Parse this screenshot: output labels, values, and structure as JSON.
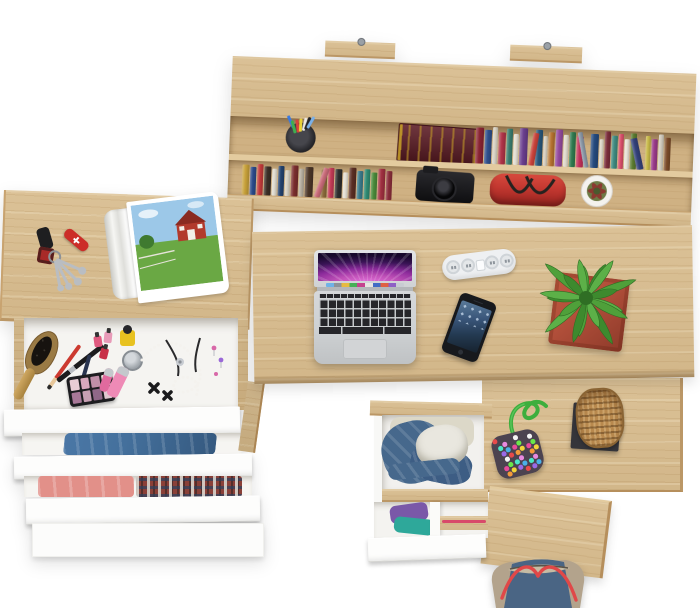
{
  "scene": {
    "kind": "top-down 3d render of a desk workspace set",
    "background": "#ffffff",
    "furniture_finish": "light oak with white drawer fronts"
  },
  "colors": {
    "wood": "#d9be91",
    "niche": "#cfb183",
    "wall_pink": "#e070d8",
    "wall_purple": "#8a2a9a",
    "wall_dark": "#17082b",
    "mac_keys": "#26262a",
    "basket": "#b8894e"
  },
  "hutch": {
    "label": "wall-mounted shelf unit with books",
    "wall_tabs": 2,
    "pen_cup": {
      "cup": "#2b2b2e",
      "pen_colors": [
        "#3a7ae0",
        "#3fae4f",
        "#d8433a",
        "#e8d23a",
        "#ece9e4",
        "#222226",
        "#7ab0e8"
      ]
    },
    "large_book": {
      "label": "antique dark-red book with gold ornament",
      "cover": "#5c1b24",
      "ornament": "#c9a227"
    },
    "camera": {
      "label": "black camera",
      "body": "#141414"
    },
    "handbag": {
      "label": "red handbag",
      "body": "#c23730",
      "strap": "#26221f"
    },
    "plant_pot": {
      "pot": "#f4f2ee",
      "foliage": "#6e7a46",
      "accent": "#8a3a30"
    },
    "top_shelf_books": [
      {
        "c": "#8a2433",
        "w": 8,
        "h": 36,
        "t": 0
      },
      {
        "c": "#2e4f8c",
        "w": 7,
        "h": 34,
        "t": 0
      },
      {
        "c": "#d8d2c4",
        "w": 5,
        "h": 37,
        "t": 0
      },
      {
        "c": "#b03448",
        "w": 7,
        "h": 32,
        "t": 0
      },
      {
        "c": "#3a7d6e",
        "w": 6,
        "h": 36,
        "t": 0
      },
      {
        "c": "#e3ded2",
        "w": 5,
        "h": 31,
        "t": 0
      },
      {
        "c": "#6a3e8e",
        "w": 8,
        "h": 37,
        "t": 0
      },
      {
        "c": "#c9423a",
        "w": 6,
        "h": 33,
        "t": 8
      },
      {
        "c": "#28567a",
        "w": 7,
        "h": 36,
        "t": 0
      },
      {
        "c": "#d6cfc0",
        "w": 4,
        "h": 30,
        "t": 0
      },
      {
        "c": "#b5722f",
        "w": 6,
        "h": 34,
        "t": 0
      },
      {
        "c": "#944a9e",
        "w": 7,
        "h": 37,
        "t": 0
      },
      {
        "c": "#e0dacc",
        "w": 5,
        "h": 32,
        "t": 0
      },
      {
        "c": "#2f7a4f",
        "w": 6,
        "h": 35,
        "t": 0
      },
      {
        "c": "#c2315a",
        "w": 7,
        "h": 31,
        "t": 0
      },
      {
        "c": "#8a97a6",
        "w": 5,
        "h": 36,
        "t": -12
      },
      {
        "c": "#254a7e",
        "w": 8,
        "h": 34,
        "t": 0
      },
      {
        "c": "#ddd7c9",
        "w": 4,
        "h": 29,
        "t": 0
      },
      {
        "c": "#7a2d3a",
        "w": 6,
        "h": 37,
        "t": 0
      },
      {
        "c": "#3f8a80",
        "w": 6,
        "h": 33,
        "t": 0
      },
      {
        "c": "#d94f6a",
        "w": 5,
        "h": 35,
        "t": 0
      },
      {
        "c": "#e8e3d6",
        "w": 5,
        "h": 30,
        "t": 0
      },
      {
        "c": "#5a7a2f",
        "w": 6,
        "h": 36,
        "t": 0
      },
      {
        "c": "#33417a",
        "w": 7,
        "h": 32,
        "t": -14
      },
      {
        "c": "#c8b94a",
        "w": 5,
        "h": 34,
        "t": 0
      },
      {
        "c": "#9a3a8a",
        "w": 6,
        "h": 31,
        "t": 0
      },
      {
        "c": "#d0cabc",
        "w": 5,
        "h": 36,
        "t": 0
      },
      {
        "c": "#7a4a28",
        "w": 6,
        "h": 33,
        "t": 0
      }
    ],
    "lower_shelf_books": [
      {
        "c": "#c8a13a",
        "w": 7,
        "h": 30,
        "t": 0
      },
      {
        "c": "#2b4a8a",
        "w": 6,
        "h": 28,
        "t": 0
      },
      {
        "c": "#c23a3a",
        "w": 6,
        "h": 31,
        "t": 0
      },
      {
        "c": "#3a2e26",
        "w": 7,
        "h": 29,
        "t": 0
      },
      {
        "c": "#e0dcd0",
        "w": 5,
        "h": 27,
        "t": 0
      },
      {
        "c": "#23426e",
        "w": 6,
        "h": 30,
        "t": 0
      },
      {
        "c": "#d6d0c2",
        "w": 5,
        "h": 26,
        "t": 0
      },
      {
        "c": "#7a2d2d",
        "w": 7,
        "h": 31,
        "t": 0
      },
      {
        "c": "#b5ad9e",
        "w": 5,
        "h": 28,
        "t": 0
      },
      {
        "c": "#4a3527",
        "w": 8,
        "h": 30,
        "t": 0
      },
      {
        "c": "#c86a78",
        "w": 6,
        "h": 31,
        "t": 18
      },
      {
        "c": "#8a6a3a",
        "w": 6,
        "h": 28,
        "t": 0
      },
      {
        "c": "#c23a55",
        "w": 6,
        "h": 30,
        "t": 0
      },
      {
        "c": "#2d2d2d",
        "w": 7,
        "h": 29,
        "t": 0
      },
      {
        "c": "#e5e0d4",
        "w": 5,
        "h": 26,
        "t": 0
      },
      {
        "c": "#5a2d23",
        "w": 7,
        "h": 31,
        "t": 0
      },
      {
        "c": "#3a7a8a",
        "w": 6,
        "h": 28,
        "t": 0
      },
      {
        "c": "#2f8a72",
        "w": 6,
        "h": 30,
        "t": 0
      },
      {
        "c": "#4a8a3a",
        "w": 6,
        "h": 27,
        "t": 0
      },
      {
        "c": "#a03040",
        "w": 7,
        "h": 31,
        "t": 0
      },
      {
        "c": "#8a2d3a",
        "w": 6,
        "h": 29,
        "t": 0
      }
    ]
  },
  "dresser": {
    "label": "vanity dresser with cascading open drawers",
    "tabletop_items": {
      "car_key_fob": "#1e1e20",
      "pocket_knife": {
        "body": "#cc2d28",
        "cross": "#ffffff"
      },
      "keychain_fob": "#a82a28",
      "keys": "#b9bdc2",
      "magazine": {
        "label": "open magazine with red barn photo",
        "sky": "#9cc8e8",
        "grass": "#6aa844",
        "barn": "#b23a2c",
        "roof": "#8a2a20",
        "page": "#ffffff"
      }
    },
    "makeup_drawer": {
      "label": "open drawer with cosmetics and jewelry",
      "palette_shades": [
        "#e8ccd4",
        "#d8a8bc",
        "#c090a8",
        "#ece4dc",
        "#a87898",
        "#c8a0b4",
        "#906888",
        "#e0c8d0"
      ],
      "hairbrush_wood": "#9a7a44",
      "lip_gloss": "#ee8ab6",
      "lip_gloss_small": "#e06a9e",
      "nail_polish_yellow": "#e8c220",
      "mini_bottles": [
        "#e05a80",
        "#e89ab8",
        "#c83048"
      ],
      "pearls": "#f4f2ee"
    },
    "jeans_drawer": {
      "denim": "#44709c"
    },
    "clothes_drawer": {
      "pink": "#e29089",
      "plaid_base": "#8a4038"
    }
  },
  "desk": {
    "label": "main desk surface",
    "laptop": {
      "label": "open laptop with purple aurora wallpaper",
      "dock_colors": [
        "#6ab0e8",
        "#8a8f96",
        "#e8b93a",
        "#3fae4f",
        "#c43a8a",
        "#e8e6e2",
        "#3a66c4",
        "#e05a3a",
        "#8a5ac4",
        "#c8ccd2"
      ]
    },
    "power_strip": {
      "label": "white power strip",
      "sockets": 4,
      "body": "#eef0f2"
    },
    "phone": {
      "label": "smartphone with dark blue screen",
      "body": "#17191d"
    },
    "plant": {
      "label": "succulent in terracotta planter",
      "pot": "#b14f3a",
      "leaves": 18,
      "leaf_colors": [
        "#4fa03a",
        "#3d8a2e",
        "#5cb048"
      ]
    },
    "pouch": {
      "label": "beaded pouch with green cord",
      "base": "#4c4350",
      "cord": "#3dae3d",
      "dot_colors": [
        "#e84a4a",
        "#f2d43a",
        "#4ab0e8",
        "#6ae84a",
        "#e88ae0",
        "#f4f4f4",
        "#f49a3a",
        "#9a6ae8",
        "#e84a9a",
        "#4ae8c8"
      ]
    },
    "basket": {
      "label": "woven basket on dark mat",
      "mat": "#35353a"
    }
  },
  "under_desk": {
    "drawer_open": {
      "label": "open drawer with denim jacket and white cloth",
      "denim": "#46688c",
      "denim_deep": "#3d5d84",
      "cloth": "#e9e7df",
      "under_cloth": "#dcd8c8"
    },
    "drawer_lower": {
      "label": "lower drawer with folded clothes",
      "purple": "#7a58a8",
      "teal": "#2ea89a",
      "pink_stripe": "#d84a6a"
    }
  },
  "floor_bag": {
    "label": "canvas tote bag with red straps",
    "body": "#b3a38c",
    "denim": "#4a6584",
    "inner": "#c6bba4",
    "straps": "#e04848"
  }
}
